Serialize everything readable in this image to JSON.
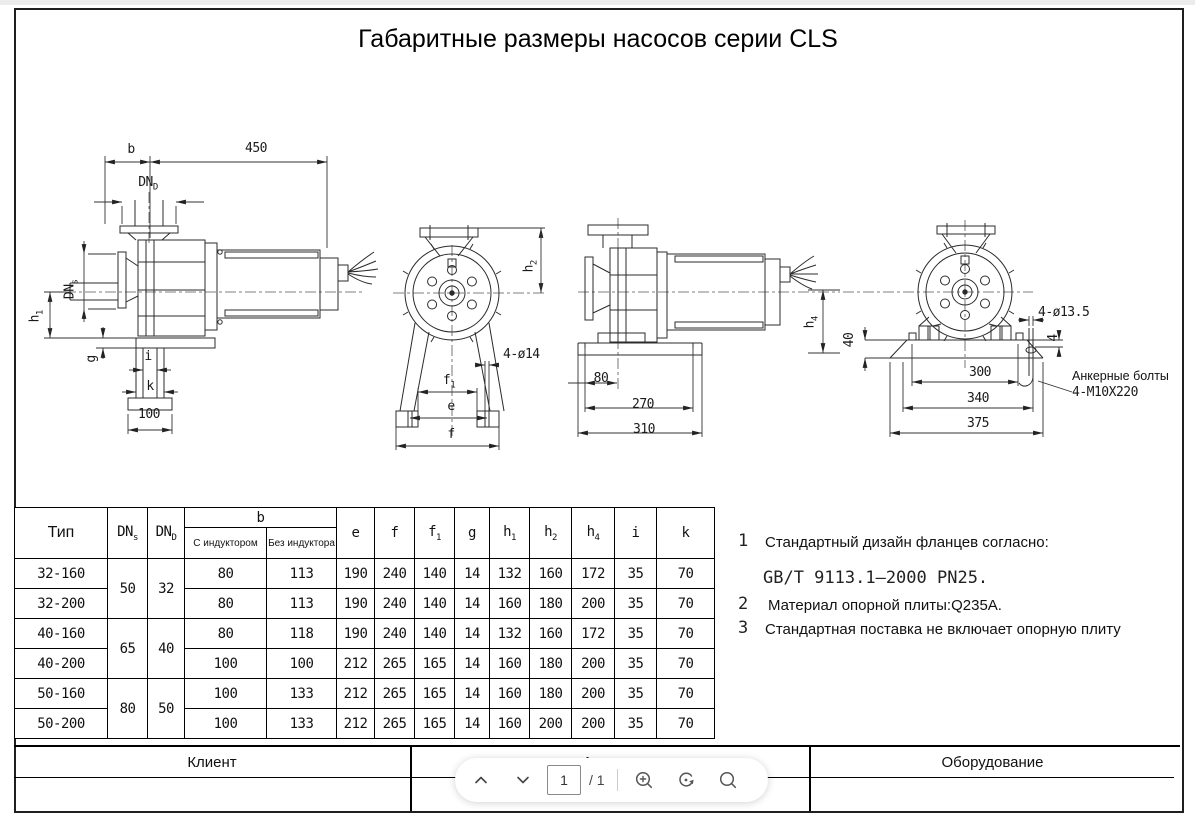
{
  "page": {
    "title": "Габаритные размеры насосов серии CLS"
  },
  "drawings": {
    "view1": {
      "dim_b": "b",
      "dim_450": "450",
      "dnd_base": "DN",
      "dnd_sub": "D",
      "dns_base": "DN",
      "dns_sub": "s",
      "h1_base": "h",
      "h1_sub": "1",
      "dim_g": "g",
      "dim_i": "i",
      "dim_k": "k",
      "dim_100": "100"
    },
    "view2": {
      "h2_base": "h",
      "h2_sub": "2",
      "dim_holes": "4-ø14",
      "f1_base": "f",
      "f1_sub": "1",
      "dim_e": "e",
      "dim_f": "f"
    },
    "view3": {
      "dim_80": "80",
      "dim_270": "270",
      "dim_310": "310",
      "h4_base": "h",
      "h4_sub": "4"
    },
    "view4": {
      "dim_40": "40",
      "dim_holes": "4-ø13.5",
      "dim_4": "4",
      "dim_300": "300",
      "dim_340": "340",
      "dim_375": "375",
      "anchor_line1": "Анкерные болты",
      "anchor_line2": "4-M10X220"
    }
  },
  "table": {
    "headers": {
      "type": "Тип",
      "dns_base": "DN",
      "dns_sub": "s",
      "dnd_base": "DN",
      "dnd_sub": "D",
      "b": "b",
      "b_with": "С индуктором",
      "b_without": "Без индуктора",
      "e": "e",
      "f": "f",
      "f1_base": "f",
      "f1_sub": "1",
      "g": "g",
      "h1_base": "h",
      "h1_sub": "1",
      "h2_base": "h",
      "h2_sub": "2",
      "h4_base": "h",
      "h4_sub": "4",
      "i": "i",
      "k": "k"
    },
    "rows": [
      {
        "type": "32-160",
        "dns": "50",
        "dnd": "32",
        "b_with": "80",
        "b_without": "113",
        "e": "190",
        "f": "240",
        "f1": "140",
        "g": "14",
        "h1": "132",
        "h2": "160",
        "h4": "172",
        "i": "35",
        "k": "70"
      },
      {
        "type": "32-200",
        "b_with": "80",
        "b_without": "113",
        "e": "190",
        "f": "240",
        "f1": "140",
        "g": "14",
        "h1": "160",
        "h2": "180",
        "h4": "200",
        "i": "35",
        "k": "70"
      },
      {
        "type": "40-160",
        "dns": "65",
        "dnd": "40",
        "b_with": "80",
        "b_without": "118",
        "e": "190",
        "f": "240",
        "f1": "140",
        "g": "14",
        "h1": "132",
        "h2": "160",
        "h4": "172",
        "i": "35",
        "k": "70"
      },
      {
        "type": "40-200",
        "b_with": "100",
        "b_without": "100",
        "e": "212",
        "f": "265",
        "f1": "165",
        "g": "14",
        "h1": "160",
        "h2": "180",
        "h4": "200",
        "i": "35",
        "k": "70"
      },
      {
        "type": "50-160",
        "dns": "80",
        "dnd": "50",
        "b_with": "100",
        "b_without": "133",
        "e": "212",
        "f": "265",
        "f1": "165",
        "g": "14",
        "h1": "160",
        "h2": "180",
        "h4": "200",
        "i": "35",
        "k": "70"
      },
      {
        "type": "50-200",
        "b_with": "100",
        "b_without": "133",
        "e": "212",
        "f": "265",
        "f1": "165",
        "g": "14",
        "h1": "160",
        "h2": "200",
        "h4": "200",
        "i": "35",
        "k": "70"
      }
    ]
  },
  "notes": [
    {
      "num": "1",
      "text": "Стандартный дизайн фланцев согласно:",
      "text2": "GB/T 9113.1–2000 PN25."
    },
    {
      "num": "2",
      "text": "Материал опорной плиты:Q235A."
    },
    {
      "num": "3",
      "text": "Стандартная поставка не включает опорную плиту"
    }
  ],
  "footer": {
    "client": "Клиент",
    "article": "Артикул",
    "equipment": "Оборудование"
  },
  "toolbar": {
    "page_value": "1",
    "page_total": "/ 1"
  }
}
